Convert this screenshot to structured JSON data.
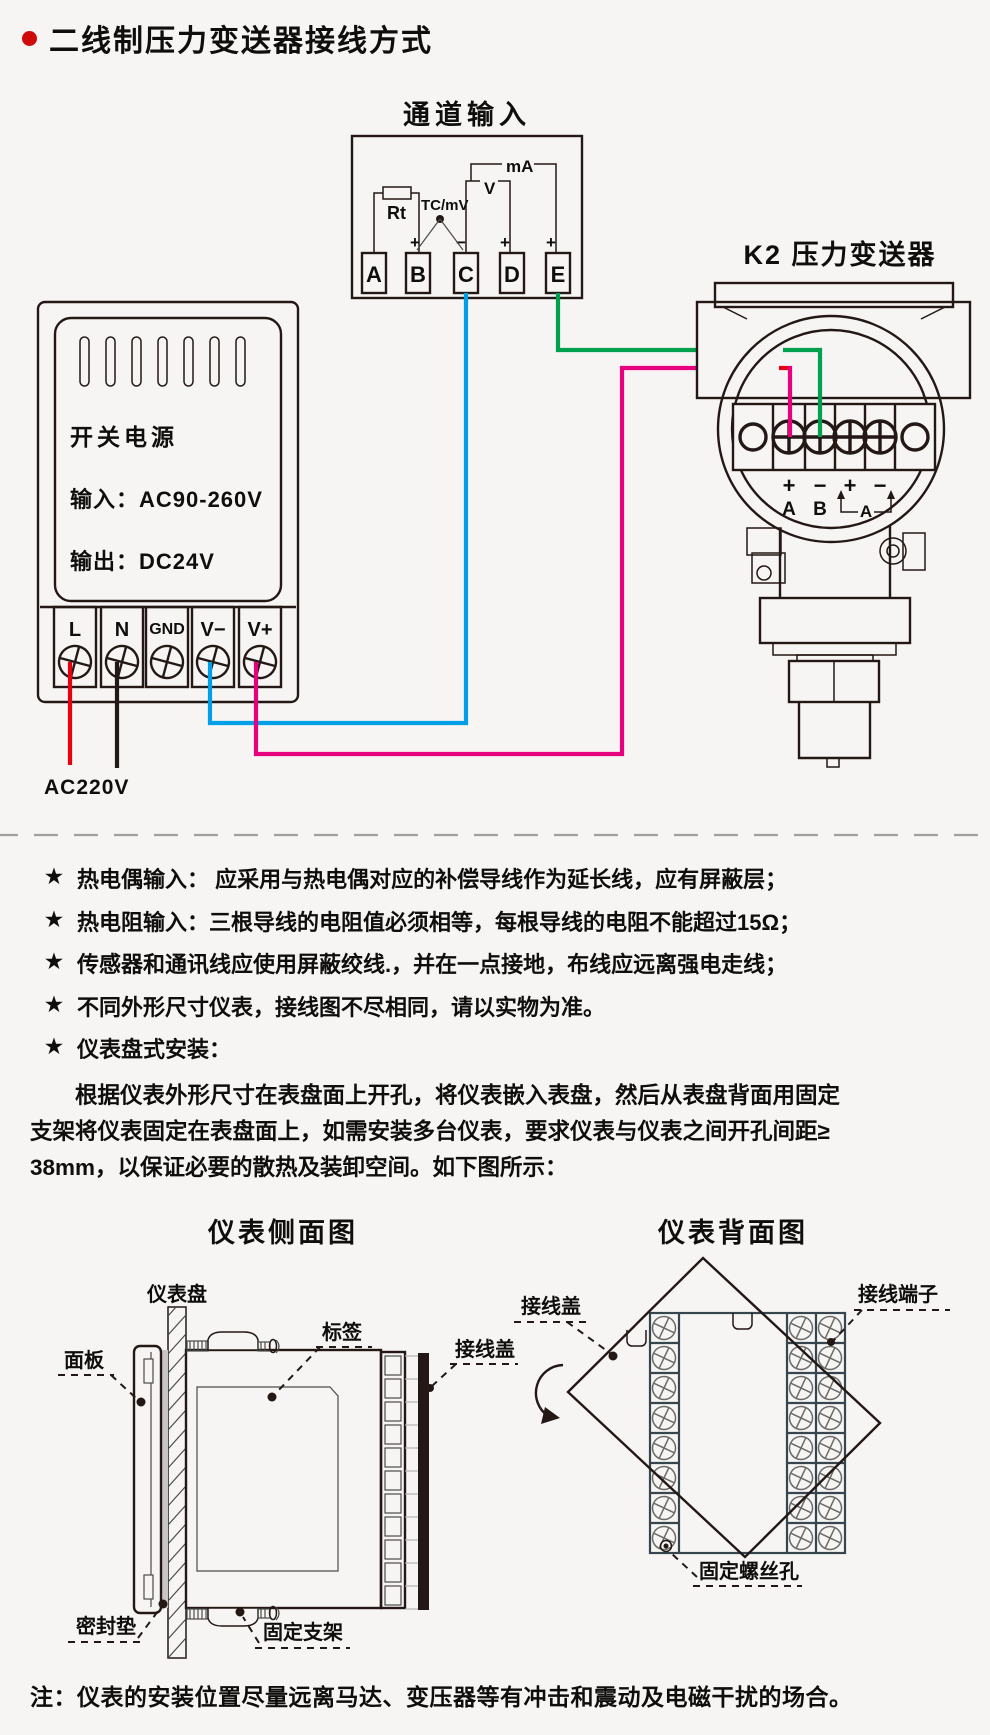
{
  "title": "二线制压力变送器接线方式",
  "colors": {
    "line": "#231815",
    "red": "#e60012",
    "blue": "#00a0e9",
    "green": "#00a04e",
    "magenta": "#e6007e",
    "bg": "#f6f5f3",
    "accent": "#cf0a0a"
  },
  "wiring": {
    "channel": {
      "title": "通道输入",
      "rt": "Rt",
      "tc": "TC/mV",
      "v": "V",
      "ma": "mA",
      "terminals": [
        "A",
        "B",
        "C",
        "D",
        "E"
      ],
      "signs": [
        "+",
        "−",
        "+",
        "+"
      ]
    },
    "transmitter": {
      "title": "K2 压力变送器",
      "signs": [
        "+",
        "−",
        "+",
        "−"
      ],
      "letters": [
        "A",
        "B"
      ],
      "loop": "A"
    },
    "psu": {
      "name": "开关电源",
      "line_input": "输入：AC90-260V",
      "line_output": "输出：DC24V",
      "terminals": [
        "L",
        "N",
        "GND",
        "V−",
        "V+"
      ],
      "mains": "AC220V"
    }
  },
  "bullets": {
    "marker": "★",
    "items": [
      "热电偶输入： 应采用与热电偶对应的补偿导线作为延长线，应有屏蔽层；",
      "热电阻输入：三根导线的电阻值必须相等，每根导线的电阻不能超过15Ω；",
      "传感器和通讯线应使用屏蔽绞线.，并在一点接地，布线应远离强电走线；",
      "不同外形尺寸仪表，接线图不尽相同，请以实物为准。",
      "仪表盘式安装："
    ]
  },
  "paragraph": {
    "line1": "根据仪表外形尺寸在表盘面上开孔，将仪表嵌入表盘，然后从表盘背面用固定",
    "line2": "支架将仪表固定在表盘面上，如需安装多台仪表，要求仪表与仪表之间开孔间距≥",
    "line3": "38mm，以保证必要的散热及装卸空间。如下图所示："
  },
  "diagrams": {
    "side": {
      "title": "仪表侧面图",
      "panel": "仪表盘",
      "sticker": "标签",
      "front": "面板",
      "cover": "接线盖",
      "gasket": "密封垫",
      "bracket": "固定支架"
    },
    "back": {
      "title": "仪表背面图",
      "cover": "接线盖",
      "terminals": "接线端子",
      "hole": "固定螺丝孔"
    }
  },
  "footer_note": "注：仪表的安装位置尽量远离马达、变压器等有冲击和震动及电磁干扰的场合。"
}
